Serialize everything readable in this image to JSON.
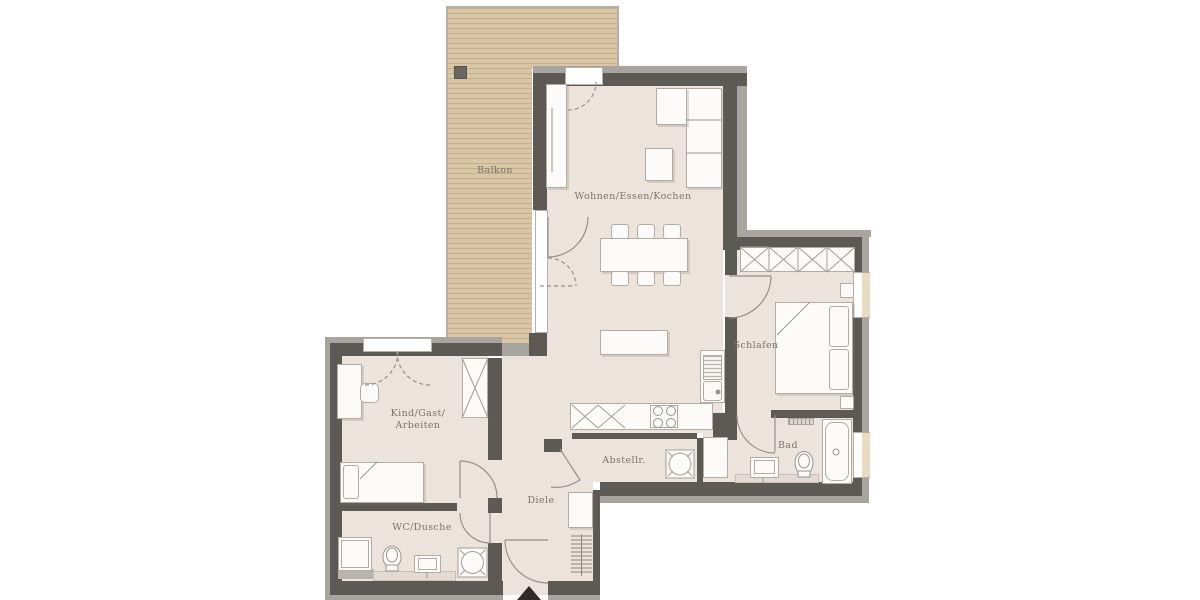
{
  "rooms": {
    "balkon": {
      "label": "Balkon"
    },
    "wohnen": {
      "label": "Wohnen/Essen/Kochen"
    },
    "schlafen": {
      "label": "Schlafen"
    },
    "kind_gast_arbeiten": {
      "line1": "Kind/Gast/",
      "line2": "Arbeiten"
    },
    "wc_dusche": {
      "label": "WC/Dusche"
    },
    "diele": {
      "label": "Diele"
    },
    "abstellraum": {
      "label": "Abstellr."
    },
    "bad": {
      "label": "Bad"
    }
  },
  "colors": {
    "floor": "#ece3dc",
    "wall-dark": "#5d5955",
    "wall-light": "#a8a49f",
    "wood-base": "#d9c6a6",
    "wood-stripe": "#c6ae8a",
    "fur-fill": "#fcfbfa",
    "fur-line": "#b2aca4",
    "window-tan": "#e9dcc3",
    "label": "#7a736c",
    "arrow": "#2e2b29"
  }
}
